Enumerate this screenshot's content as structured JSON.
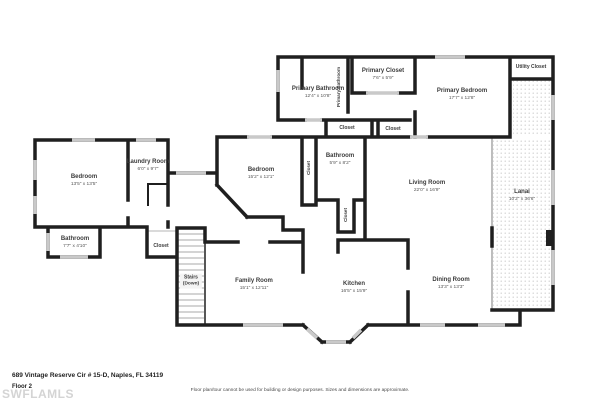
{
  "colors": {
    "wall": "#1f1f1f",
    "window": "#c9c9c9",
    "dots": "#cfcfcf",
    "watermark": "#d4d4d4",
    "text": "#3b3b3b"
  },
  "footer": {
    "address": "689 Vintage Reserve Cir # 15-D, Naples, FL 34119",
    "floor_label": "Floor 2",
    "watermark": "SWFLAMLS",
    "disclaimer": "Floor plan/tour cannot be used for building or design purposes. Sizes and dimensions are approximate."
  },
  "rooms": {
    "primary_bathroom": {
      "name": "Primary Bathroom",
      "dims": "12'4\" x 10'8\""
    },
    "primary_bathroom_wc": {
      "name": "Primary Bathroom"
    },
    "primary_closet": {
      "name": "Primary Closet",
      "dims": "7'6\" x 5'9\""
    },
    "primary_bedroom": {
      "name": "Primary Bedroom",
      "dims": "17'7\" x 12'8\""
    },
    "utility_closet": {
      "name": "Utility Closet"
    },
    "closet_a": {
      "name": "Closet"
    },
    "closet_b": {
      "name": "Closet"
    },
    "bedroom_left": {
      "name": "Bedroom",
      "dims": "13'5\" x 13'5\""
    },
    "laundry": {
      "name": "Laundry Room",
      "dims": "6'0\" x 9'7\""
    },
    "bedroom_center": {
      "name": "Bedroom",
      "dims": "15'2\" x 12'1\""
    },
    "closet_bedroom": {
      "name": "Closet"
    },
    "bathroom_center": {
      "name": "Bathroom",
      "dims": "5'9\" x 8'2\""
    },
    "closet_below_bath": {
      "name": "Closet"
    },
    "living_room": {
      "name": "Living Room",
      "dims": "22'0\" x 16'9\""
    },
    "lanai": {
      "name": "Lanai",
      "dims": "10'2\" x 36'6\""
    },
    "bathroom_left": {
      "name": "Bathroom",
      "dims": "7'7\" x 4'10\""
    },
    "closet_stairs": {
      "name": "Closet"
    },
    "stairs": {
      "name": "Stairs",
      "sub": "(Down)"
    },
    "family_room": {
      "name": "Family Room",
      "dims": "15'1\" x 12'11\""
    },
    "kitchen": {
      "name": "Kitchen",
      "dims": "16'5\" x 15'9\""
    },
    "dining_room": {
      "name": "Dining Room",
      "dims": "13'3\" x 13'3\""
    }
  }
}
